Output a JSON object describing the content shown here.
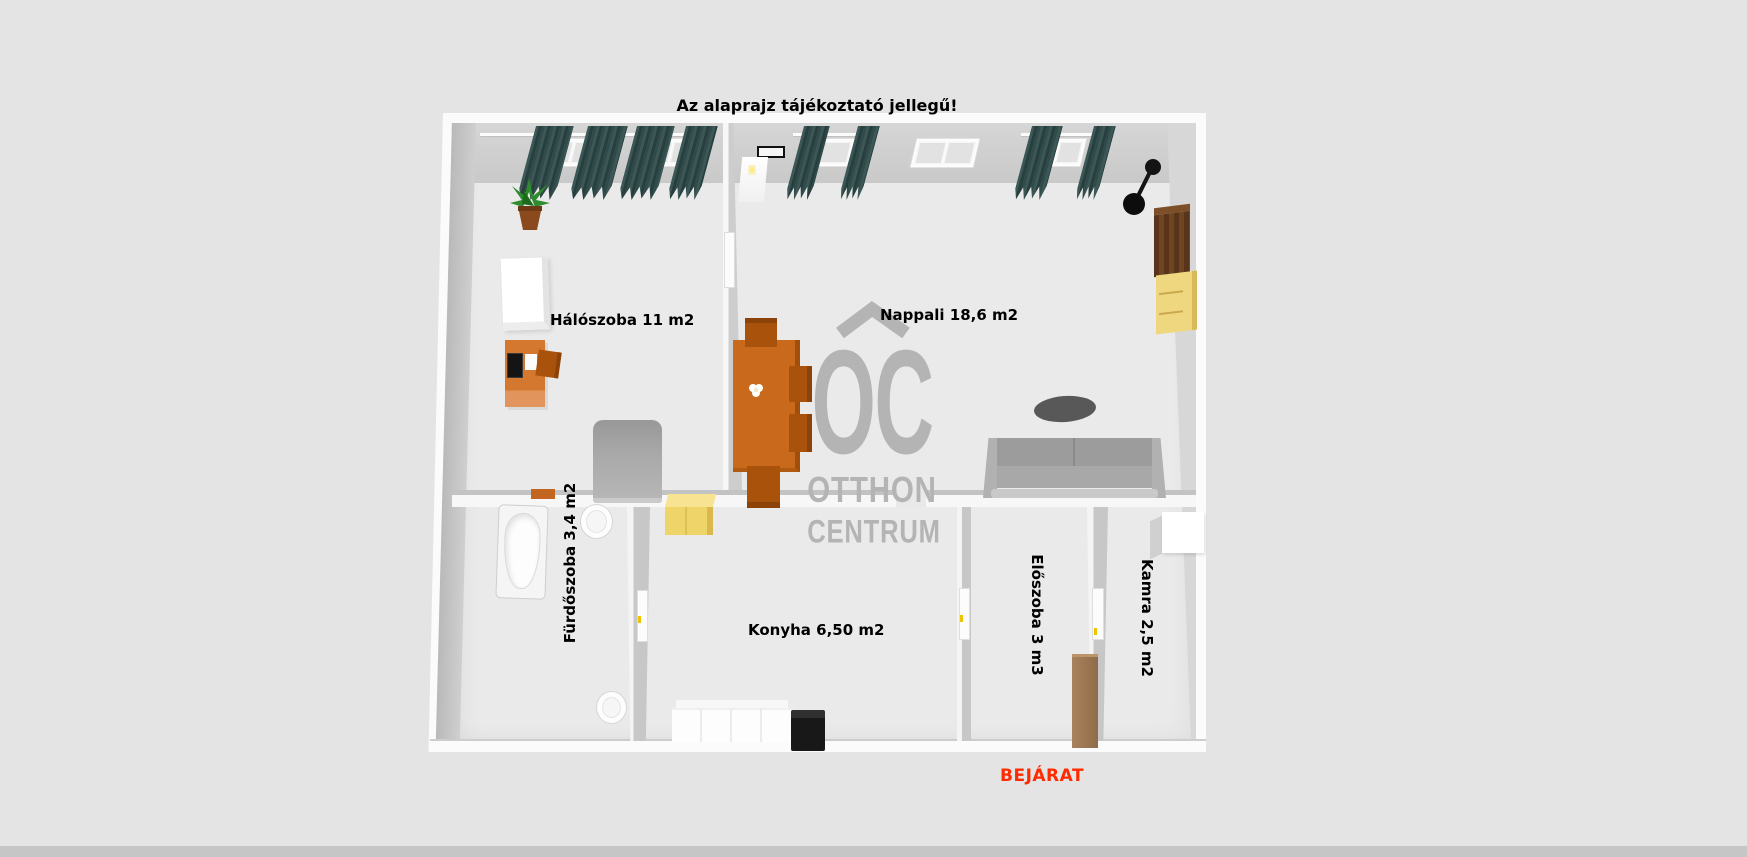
{
  "title": "Az alaprajz tájékoztató jellegű!",
  "entrance": {
    "label": "BEJÁRAT",
    "color": "#ff2b00"
  },
  "watermark": {
    "logo": "OC",
    "line1": "OTTHON",
    "line2": "CENTRUM",
    "color": "#b4b4b4"
  },
  "rooms": {
    "bedroom": {
      "label": "Hálószoba 11 m2"
    },
    "living": {
      "label": "Nappali 18,6 m2"
    },
    "bathroom": {
      "label": "Fürdőszoba 3,4 m2"
    },
    "kitchen": {
      "label": "Konyha 6,50 m2"
    },
    "hall": {
      "label": "Előszoba 3 m3"
    },
    "pantry": {
      "label": "Kamra 2,5 m2"
    }
  },
  "colors": {
    "background": "#e3e3e3",
    "floor": "#eaeaea",
    "wall_top": "#fbfbfb",
    "wall_face": "#cdcdcd",
    "curtain_teal": "#35504f",
    "furniture_orange": "#c8691b",
    "furniture_yellow": "#eed77e",
    "furniture_dark_brown": "#5f3b1d",
    "hall_cabinet_brown": "#9b7b56",
    "sofa_gray": "#9c9c9c",
    "accent_red": "#ff2b00",
    "watermark_gray": "#b4b4b4"
  }
}
